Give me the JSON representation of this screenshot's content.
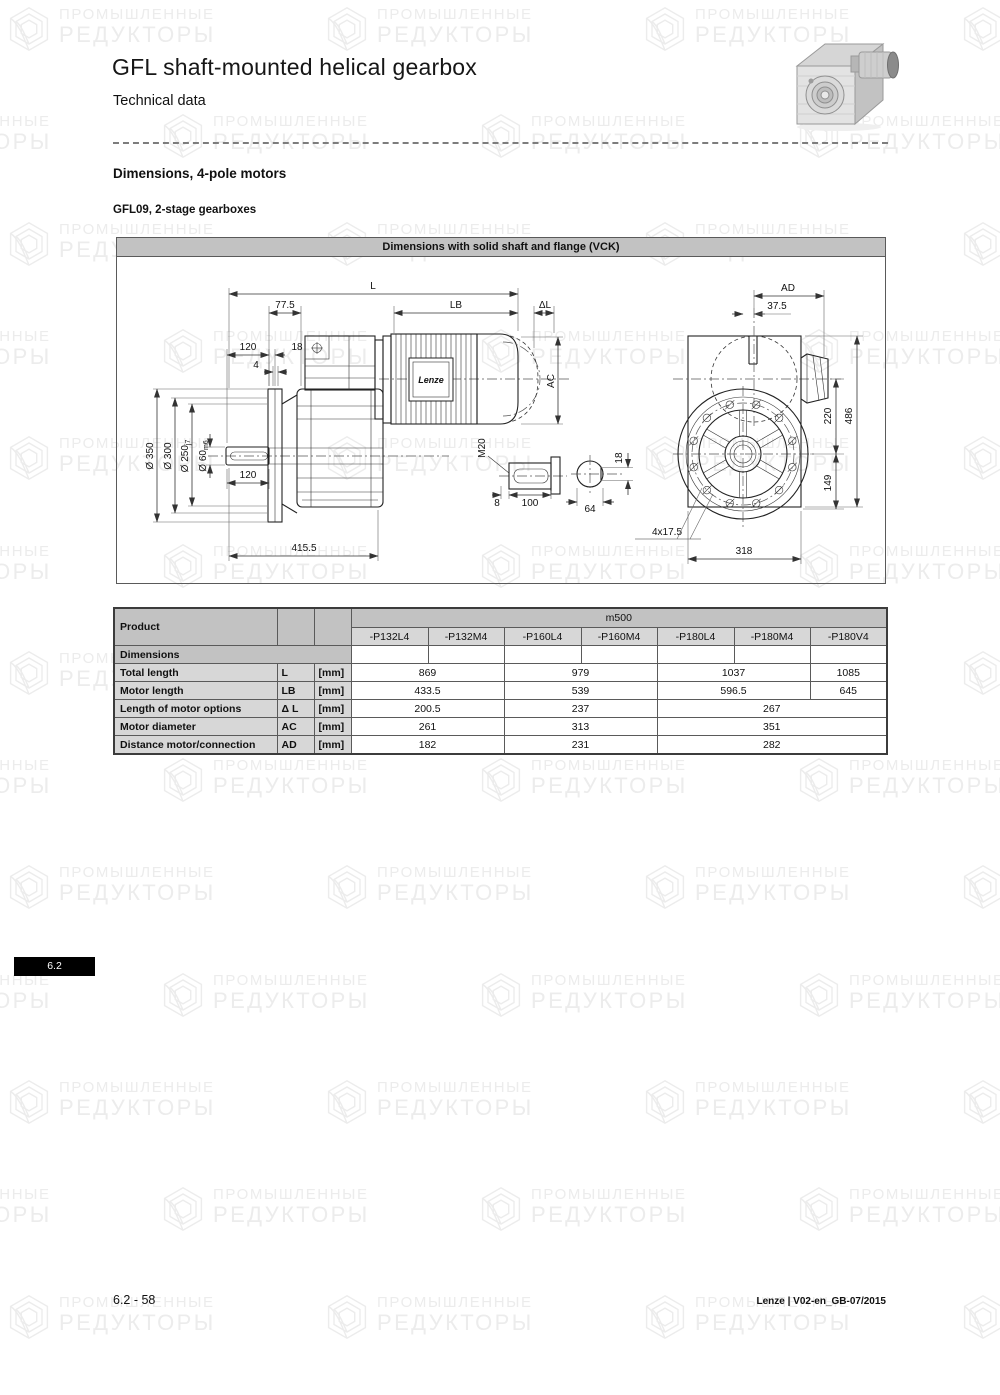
{
  "page": {
    "title": "GFL shaft-mounted helical gearbox",
    "subtitle": "Technical data",
    "section_heading": "Dimensions, 4-pole motors",
    "sub_heading": "GFL09, 2-stage gearboxes",
    "side_tab": "6.2",
    "footer_left": "6.2 - 58",
    "footer_right": "Lenze | V02-en_GB-07/2015"
  },
  "watermark": {
    "line1": "ПРОМЫШЛЕННЫЕ",
    "line2": "РЕДУКТОРЫ"
  },
  "drawing": {
    "header": "Dimensions with solid shaft and flange (VCK)",
    "motor_brand": "Lenze",
    "labels": {
      "L": "L",
      "LB": "LB",
      "delta_L": "ΔL",
      "AC": "AC",
      "AD": "AD",
      "len_77_5": "77.5",
      "len_120_top": "120",
      "len_18": "18",
      "len_4": "4",
      "dia_350": "Ø 350",
      "dia_300": "Ø 300",
      "dia_250": "Ø 250",
      "dia_250_tol": "j7",
      "dia_60": "Ø 60",
      "dia_60_tol": "m6",
      "len_120_shaft": "120",
      "len_415_5": "415.5",
      "thread_m20": "M20",
      "len_8": "8",
      "len_100": "100",
      "len_64": "64",
      "key_18": "18",
      "len_37_5": "37.5",
      "len_220": "220",
      "len_149": "149",
      "len_486": "486",
      "holes": "4x17.5",
      "len_318": "318"
    }
  },
  "table": {
    "col_group_label": "Product",
    "group_header": "m500",
    "product_columns": [
      "-P132L4",
      "-P132M4",
      "-P160L4",
      "-P160M4",
      "-P180L4",
      "-P180M4",
      "-P180V4"
    ],
    "section_label": "Dimensions",
    "rows": [
      {
        "label": "Total length",
        "symbol": "L",
        "unit": "[mm]",
        "values": [
          {
            "text": "869",
            "span": 2
          },
          {
            "text": "979",
            "span": 2
          },
          {
            "text": "1037",
            "span": 2
          },
          {
            "text": "1085",
            "span": 1
          }
        ]
      },
      {
        "label": "Motor length",
        "symbol": "LB",
        "unit": "[mm]",
        "values": [
          {
            "text": "433.5",
            "span": 2
          },
          {
            "text": "539",
            "span": 2
          },
          {
            "text": "596.5",
            "span": 2
          },
          {
            "text": "645",
            "span": 1
          }
        ]
      },
      {
        "label": "Length of motor options",
        "symbol": "Δ L",
        "unit": "[mm]",
        "values": [
          {
            "text": "200.5",
            "span": 2
          },
          {
            "text": "237",
            "span": 2
          },
          {
            "text": "267",
            "span": 3
          }
        ]
      },
      {
        "label": "Motor diameter",
        "symbol": "AC",
        "unit": "[mm]",
        "values": [
          {
            "text": "261",
            "span": 2
          },
          {
            "text": "313",
            "span": 2
          },
          {
            "text": "351",
            "span": 3
          }
        ]
      },
      {
        "label": "Distance motor/connection",
        "symbol": "AD",
        "unit": "[mm]",
        "values": [
          {
            "text": "182",
            "span": 2
          },
          {
            "text": "231",
            "span": 2
          },
          {
            "text": "282",
            "span": 3
          }
        ]
      }
    ]
  },
  "colors": {
    "header_bar_gray": "#c2c2c2",
    "row_gray": "#d7d7d7",
    "tab_black": "#000000",
    "watermark_gray": "#ececec"
  }
}
